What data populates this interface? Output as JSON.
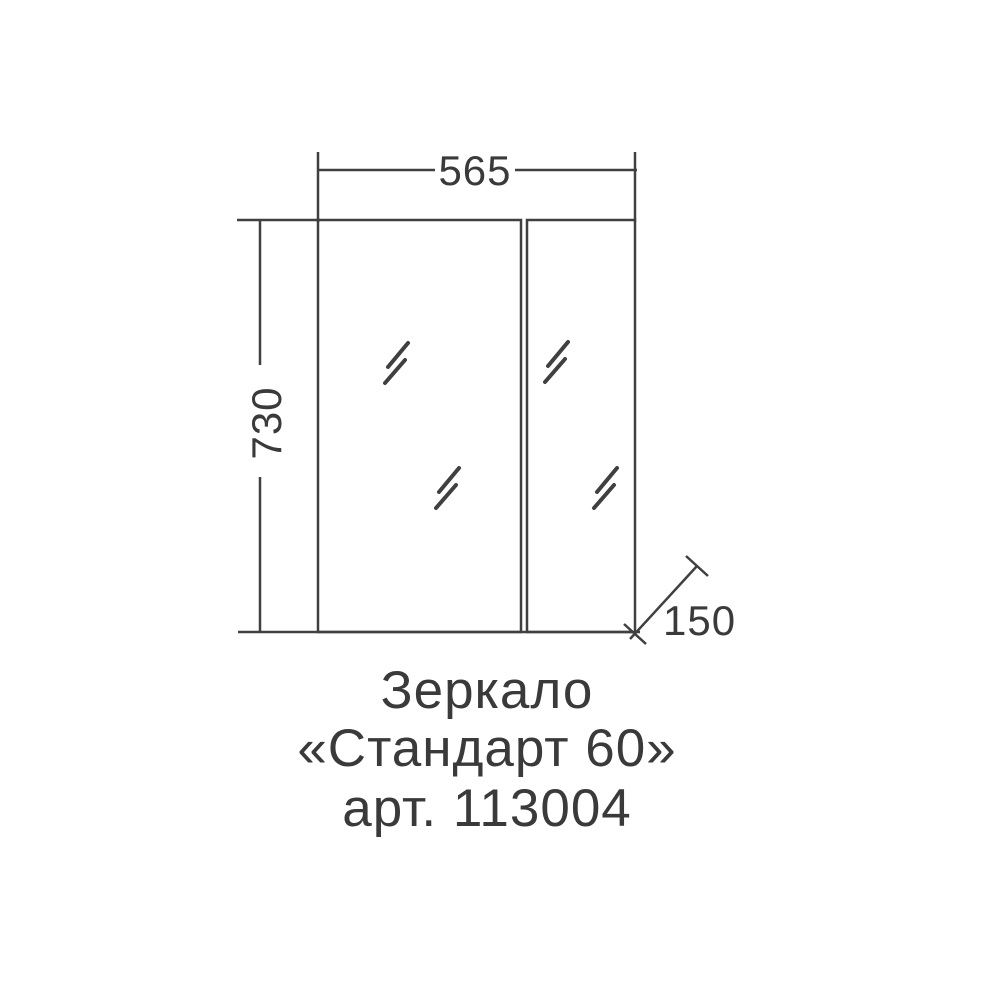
{
  "diagram": {
    "product": {
      "caption_line1": "Зеркало",
      "caption_line2": "«Стандарт 60»",
      "caption_line3": "арт. 113004"
    },
    "dimensions": {
      "width_mm": "565",
      "height_mm": "730",
      "depth_mm": "150"
    },
    "colors": {
      "line": "#404040",
      "text": "#3a3a3a",
      "background": "#ffffff"
    }
  }
}
